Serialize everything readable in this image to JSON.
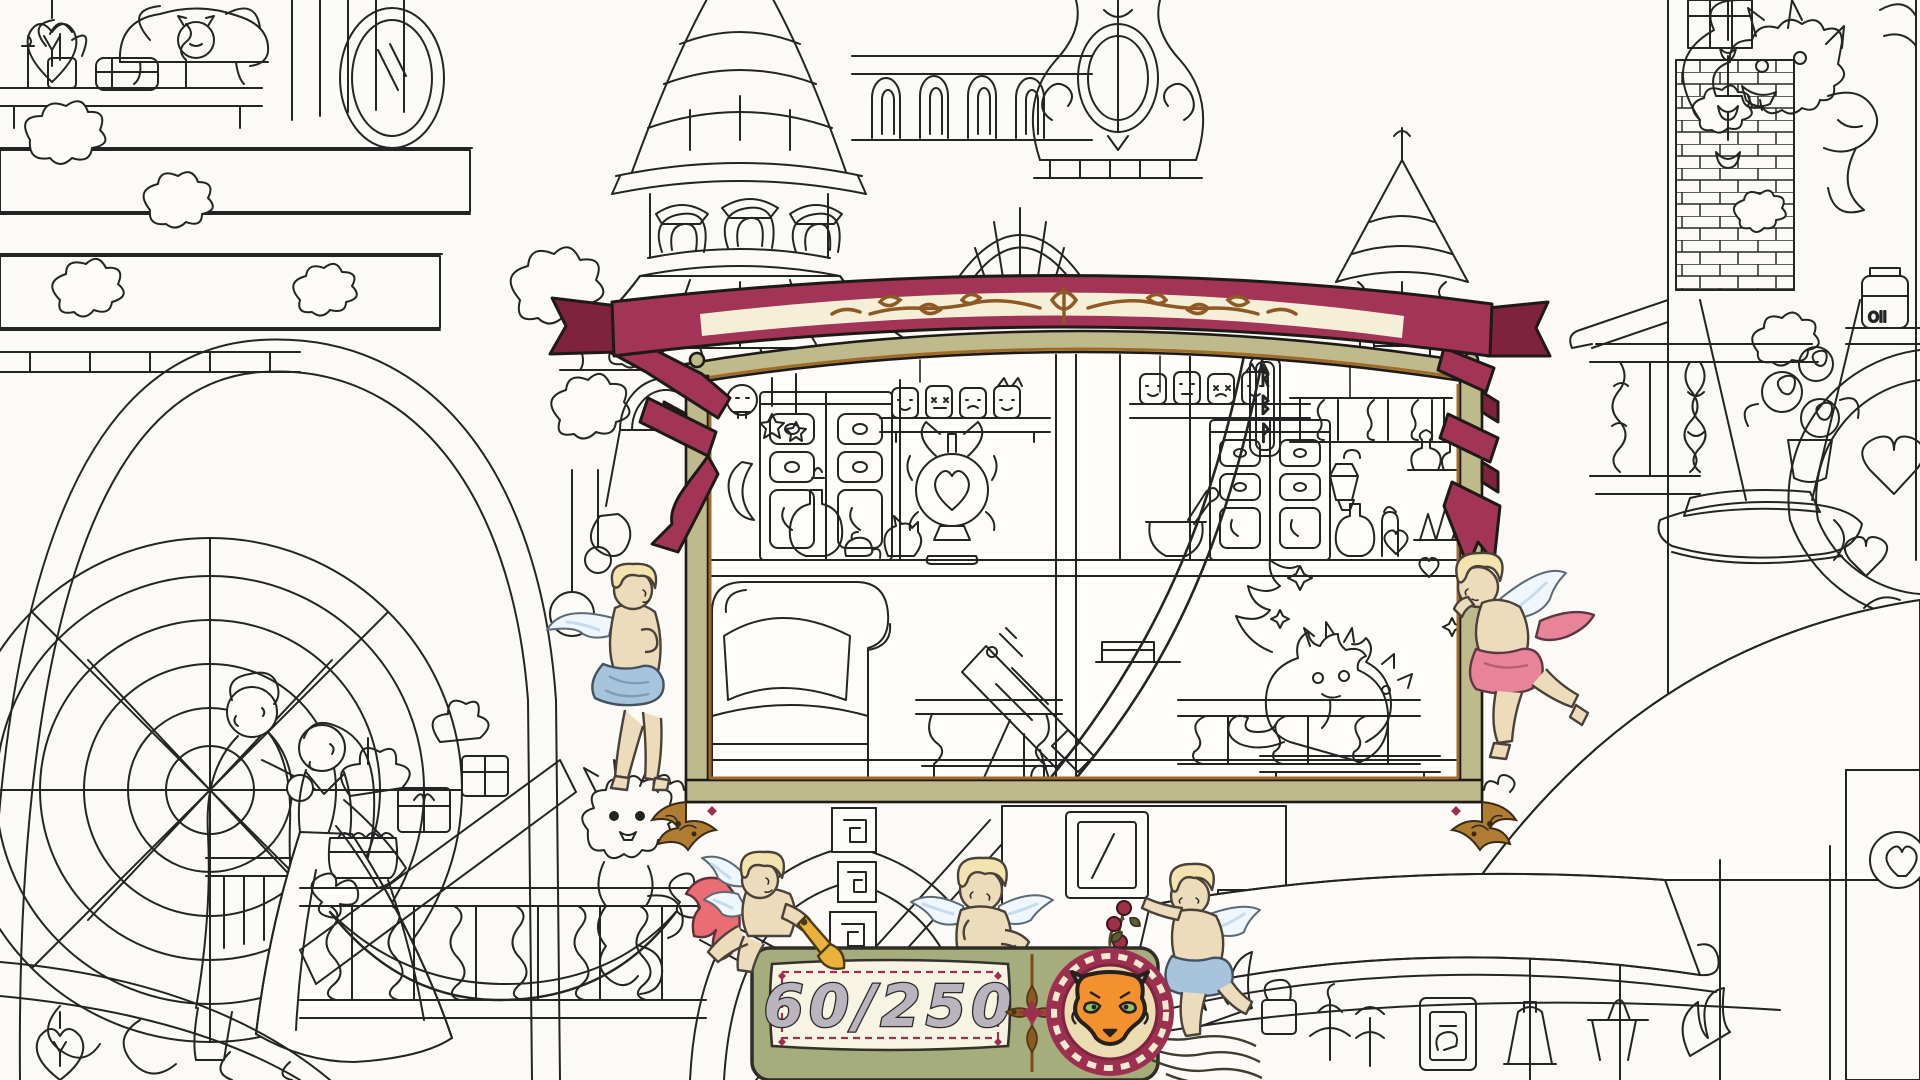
{
  "hud": {
    "counter": {
      "display": "60/250",
      "found": 60,
      "total": 250
    },
    "stamp_icon": "fox-face",
    "ornament_icon": "compass-flower"
  },
  "panel": {
    "rune_sign": [
      "ᚱ",
      "ᛒ",
      "ᚹ"
    ]
  },
  "background": {
    "oil_jar_label": "Oil"
  },
  "colors": {
    "background": "#FBFAF6",
    "ink": "#242424",
    "ribbon": "#A23457",
    "ribbon_dark": "#7E2240",
    "banner_cream": "#F6EFD8",
    "filigree_brown": "#8D5A25",
    "frame_olive": "#BEBA8B",
    "frame_trim_brown": "#A06B28",
    "corner_bronze": "#B07C33",
    "plaque_green": "#A6AD7C",
    "plaque_cream": "#F8F4E3",
    "counter_maroon": "#9D3050",
    "number_gray": "#BAB4BE",
    "fox_orange": "#F2912D",
    "fox_eye_green": "#92C36A",
    "cherub_skin": "#EDDCBC",
    "cherub_hair": "#F3E3AE",
    "cherub_wing_blue": "#C6DCEE",
    "cloth_blue": "#A8C4DD",
    "cloth_pink": "#E8849A",
    "cape_red": "#E96D72",
    "trumpet_gold": "#EBB23B"
  }
}
